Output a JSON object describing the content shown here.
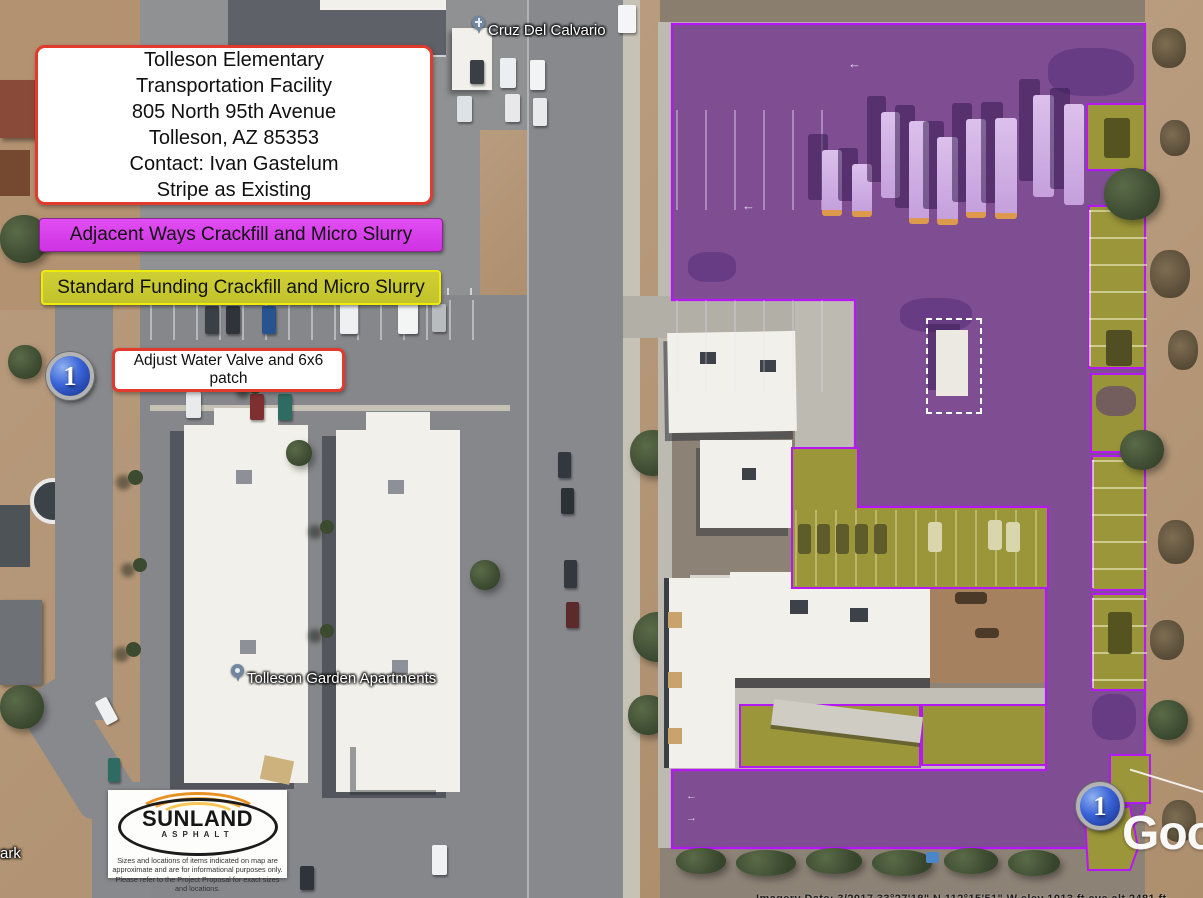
{
  "callouts": {
    "site_info": {
      "text": "Tolleson Elementary\nTransportation Facility\n805 North 95th Avenue\nTolleson, AZ 85353\nContact: Ivan Gastelum\nStripe as Existing",
      "border_color": "#e23b2e"
    },
    "water_valve": {
      "text": "Adjust Water Valve and 6x6 patch",
      "border_color": "#e23b2e"
    }
  },
  "legend": {
    "adjacent_ways": {
      "label": "Adjacent Ways Crackfill and Micro Slurry",
      "chip_color": "#d93cec"
    },
    "standard_funding": {
      "label": "Standard Funding Crackfill and Micro Slurry",
      "chip_color": "#c9c930",
      "chip_border": "#ecec08"
    }
  },
  "overlays": {
    "adjacent_ways_fill": "#7d4b93",
    "standard_funding_fill": "#9b9639",
    "boundary_color": "#b517f5"
  },
  "markers": {
    "number": "1",
    "fill": "#2a50c8"
  },
  "map_labels": {
    "church": "Cruz Del Calvario",
    "apartments": "Tolleson Garden Apartments",
    "edge_fragment": "ark"
  },
  "logo": {
    "name": "SUNLAND",
    "sub": "ASPHALT",
    "disclaimer": "Sizes and locations of items indicated on map are approximate and are for informational purposes only. Please refer to the Project Proposal for exact sizes and locations."
  },
  "watermark": {
    "text": "Google"
  },
  "status_bar": {
    "fragment": "Imagery Date: 3/2017   33°27'18\" N   112°15'51\" W   elev   1013 ft   eye alt   2481 ft"
  }
}
